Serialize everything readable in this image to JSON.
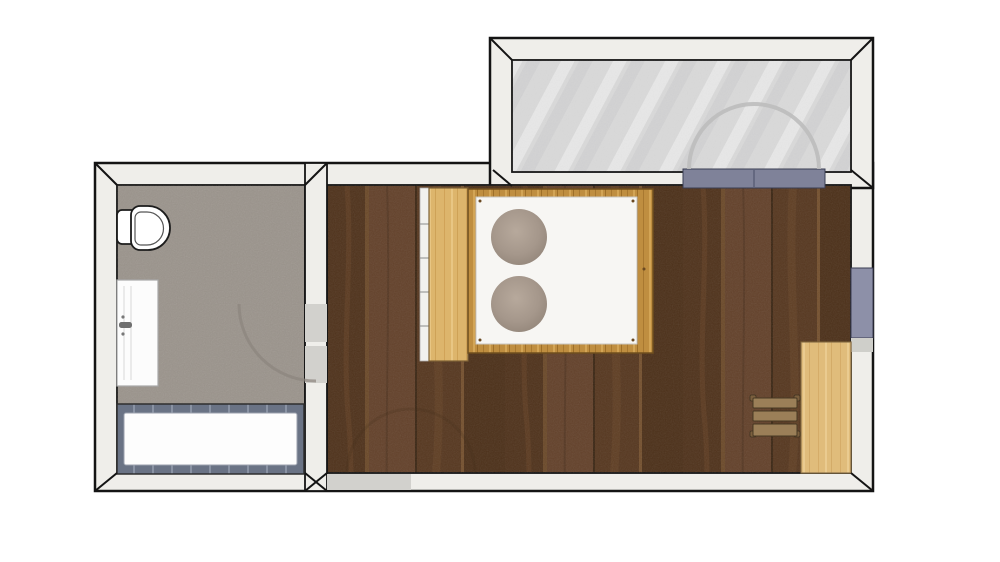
{
  "app": {
    "type": "architectural-floor-plan",
    "background": "#ffffff"
  },
  "colors": {
    "wall_fill": "#efeeea",
    "wall_line": "#141414",
    "wall_opening": "#d2d1cd",
    "wall_opening_light": "#cfcfca",
    "bathroom_floor": "#9a938b",
    "bedroom_floor": "#5a3a21",
    "balcony_floor": "#dadada",
    "window_blue": "#8d90a8",
    "balcony_door_blue": "#7f8299",
    "frame_dark": "#3a3d52",
    "tub_rim": "#6a7385",
    "tub_basin": "#fdfdfd",
    "fixture_white": "#ffffff",
    "fixture_outline": "#1c1c1c",
    "wardrobe_wood": "#ddb56c",
    "desk_wood": "#e4bf7c",
    "bed_wood": "#bf8e40",
    "wood_outline": "#7d6136",
    "mattress": "#f7f6f3",
    "pillow": "#a5978b",
    "chair_wood": "#9b7f58",
    "chair_outline": "#473823",
    "door_panel": "#fcfcfc",
    "swing_arc_bathroom": "#8b857d",
    "swing_arc_balcony": "#bdbdbd",
    "swing_arc_bedroom": "#3f2d19"
  },
  "rooms": [
    {
      "name": "bathroom",
      "floor": "textured gray"
    },
    {
      "name": "bedroom",
      "floor": "dark wood planks"
    },
    {
      "name": "balcony",
      "floor": "light gray"
    }
  ],
  "furniture": [
    {
      "name": "toilet",
      "room": "bathroom"
    },
    {
      "name": "door-panel",
      "room": "bathroom"
    },
    {
      "name": "bathtub",
      "room": "bathroom"
    },
    {
      "name": "wardrobe",
      "room": "bedroom"
    },
    {
      "name": "double-bed",
      "room": "bedroom"
    },
    {
      "name": "round-pillow",
      "room": "bedroom",
      "count": 2
    },
    {
      "name": "desk",
      "room": "bedroom"
    },
    {
      "name": "chair",
      "room": "bedroom"
    }
  ],
  "openings": [
    {
      "name": "bathroom-door-opening",
      "wall": "bathroom-bedroom"
    },
    {
      "name": "bedroom-entry-opening",
      "wall": "bottom"
    },
    {
      "name": "balcony-double-door",
      "wall": "bedroom-balcony"
    },
    {
      "name": "window",
      "wall": "right"
    }
  ]
}
